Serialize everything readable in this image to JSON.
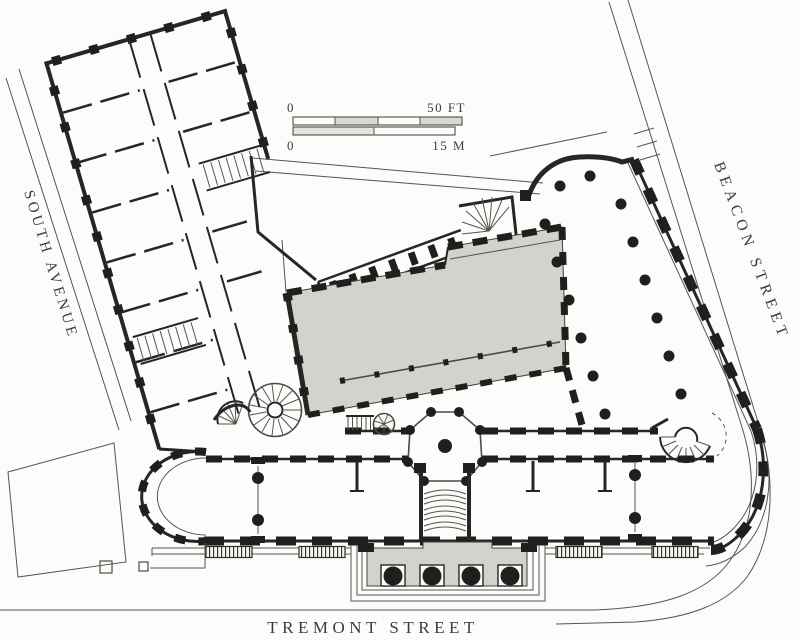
{
  "plan": {
    "type": "architectural-floor-plan",
    "streets": {
      "south_avenue": "SOUTH AVENUE",
      "beacon_street": "BEACON STREET",
      "tremont_street": "TREMONT STREET"
    },
    "scale_bar": {
      "feet_min": "0",
      "feet_max": "50 FT",
      "meters_min": "0",
      "meters_max": "15 M"
    },
    "colors": {
      "ink": "#262624",
      "thin_line": "#555550",
      "shaded_hall": "#d6d6d0",
      "paper": "#fcfcfa"
    },
    "features": {
      "shaded_hall": "central-hall-shaded",
      "column_hall": "columned-dining-hall",
      "rotunda": "octagonal-rotunda",
      "portico": "entrance-portico",
      "colonnade": "colonnade-corridor",
      "bow_end": "bowed-west-end",
      "curved_corner": "curved-corner-room",
      "stairs": [
        "grand-circular-stair",
        "curved-entrance-stair",
        "horseshoe-stair",
        "fan-stair",
        "straight-stair"
      ]
    }
  }
}
